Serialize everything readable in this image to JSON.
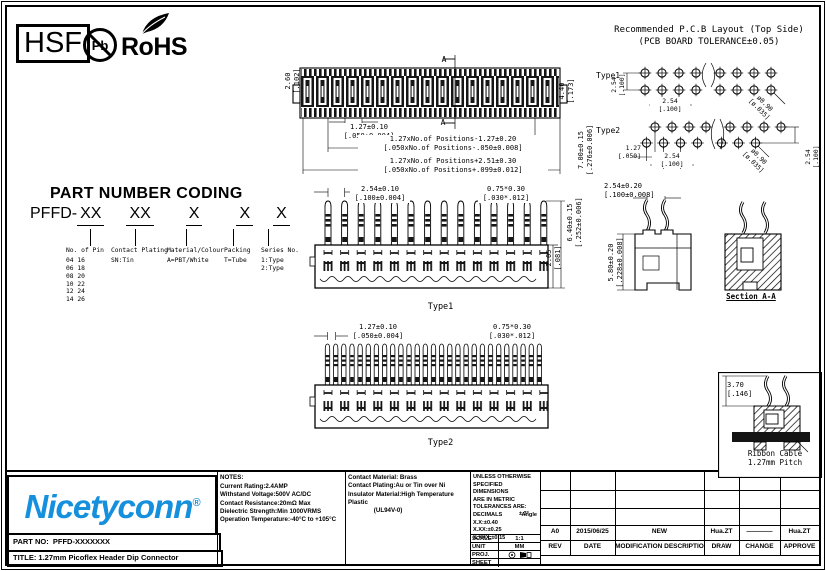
{
  "colors": {
    "brand_blue": "#1590dd",
    "line": "#000000"
  },
  "badges": {
    "hsf": "HSF",
    "pb": "Pb",
    "rohs": "RoHS"
  },
  "top_view": {
    "height_dim": "2.60\n[.102]",
    "width_dim": "4.40\n[.173]",
    "total_height_dim": "7.00±0.15\n[.276±0.006]",
    "pitch_dim": "1.27±0.10\n[.050±0.004]",
    "positions_dim1": "1.27xNo.of Positions-1.27±0.20\n[.050xNo.of Positions-.050±0.008]",
    "positions_dim2": "1.27xNo.of Positions+2.51±0.30\n[.050xNo.of Positions+.099±0.012]",
    "section_marker": "A"
  },
  "pcb": {
    "title_line1": "Recommended P.C.B Layout (Top Side)",
    "title_line2": "(PCB BOARD TOLERANCE±0.05)",
    "type1_label": "Type1",
    "type2_label": "Type2",
    "t1_row_pitch": "2.54\n[.100]",
    "t1_col_pitch": "2.54\n[.100]",
    "t1_hole_dia": "ø0.90\n[ø.035]",
    "t2_offset": "1.27\n[.050]",
    "t2_col_pitch": "2.54\n[.100]",
    "t2_hole_dia": "ø0.90\n[ø.035]",
    "t2_row_pitch": "2.54\n[.100]"
  },
  "coding": {
    "title": "PART NUMBER CODING",
    "prefix": "PFFD-",
    "seg1": "XX",
    "seg2": "XX",
    "seg3": "X",
    "seg4": "X",
    "seg5": "X",
    "col1_title": "No. of Pin",
    "col1_lines": "04 16\n06 18\n08 20\n10 22\n12 24\n14 26",
    "col2_title": "Contact Plating",
    "col2_lines": "SN:Tin",
    "col3_title": "Material/Colour",
    "col3_lines": "A=PBT/White",
    "col4_title": "Packing",
    "col4_lines": "T=Tube",
    "col5_title": "Series No.",
    "col5_lines": "1:Type\n2:Type"
  },
  "type1": {
    "label": "Type1",
    "pitch_dim": "2.54±0.10\n[.100±0.004]",
    "pin_dim": "0.75*0.30\n[.030*.012]",
    "height_dim": "6.40±0.15\n[.252±0.006]",
    "body_dim": "2.05\n[.081]"
  },
  "section": {
    "top_dim": "2.54±0.20\n[.100±0.008]",
    "height_dim": "5.80±0.20\n[.228±0.008]",
    "label": "Section A-A"
  },
  "type2": {
    "label": "Type2",
    "pitch_dim": "1.27±0.10\n[.050±0.004]",
    "pin_dim": "0.75*0.30\n[.030*.012]"
  },
  "ribbon": {
    "dim": "3.70\n[.146]",
    "label": "Ribbon Cable\n1.27mm Pitch"
  },
  "titleblock": {
    "brand": "Nicetyconn",
    "reg": "®",
    "part_no_label": "PART NO:",
    "part_no": "PFFD-XXXXXXX",
    "title_label": "TITLE:",
    "title": "1.27mm Picoflex Header Dip Connector",
    "notes_header": "NOTES:",
    "notes": "Current Rating:2.4AMP\nWithstand Voltage:500V AC/DC\nContact Resistance:20mΩ Max\nDielectric Strength:Min 1000VRMS\nOperation Temperature:-40°C to +105°C",
    "materials": "Contact Material: Brass\nContact Plating:Au or Tin over Ni\nInsulator Material:High Temperature Plastic\n               (UL94V-0)",
    "tol_header": "UNLESS OTHERWISE\nSPECIFIED DIMENSIONS\nARE IN METRIC\nTOLERANCES ARE:",
    "tol_decimals_label": "DECIMALS",
    "tol_angle_label": "Angle",
    "tol_lines": "X.X:±0.40\nX.XX:±0.25\nX.XXX:±0.15",
    "tol_angle_value": "± 3°",
    "scale_label": "SCALE",
    "scale_value": "1:1",
    "unit_label": "UNIT",
    "unit_value": "MM",
    "proj_label": "PROJ.",
    "sheet_label": "SHEET",
    "rev": {
      "rev": "A0",
      "date": "2015/06/25",
      "desc": "NEW",
      "draw": "Hua.ZT",
      "change": "————",
      "approve": "Hua.ZT"
    },
    "rev_header": {
      "rev": "REV",
      "date": "DATE",
      "desc": "MODIFICATION DESCRIPTIO",
      "draw": "DRAW",
      "change": "CHANGE",
      "approve": "APPROVE"
    }
  }
}
